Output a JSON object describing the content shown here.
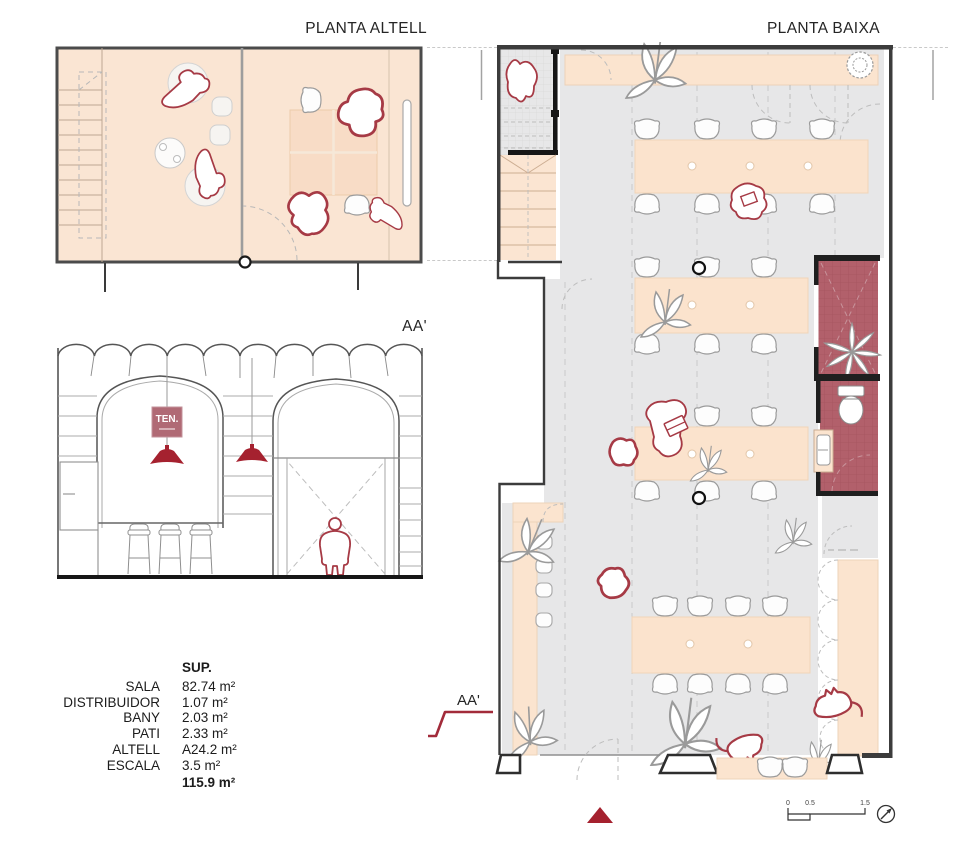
{
  "titles": {
    "altell": "PLANTA ALTELL",
    "baixa": "PLANTA BAIXA",
    "section": "AA'",
    "section_marker": "AA'"
  },
  "section": {
    "sign_text": "TEN."
  },
  "sup_table": {
    "header": "SUP.",
    "rows": [
      {
        "label": "SALA",
        "value": "82.74 m²"
      },
      {
        "label": "DISTRIBUIDOR",
        "value": "1.07 m²"
      },
      {
        "label": "BANY",
        "value": "2.03 m²"
      },
      {
        "label": "PATI",
        "value": "2.33 m²"
      },
      {
        "label": "ALTELL",
        "value": "A24.2 m²"
      },
      {
        "label": "ESCALA",
        "value": "3.5 m²"
      }
    ],
    "total": "115.9 m²"
  },
  "scale_bar": {
    "ticks": [
      "0",
      "0.5",
      "1.5"
    ]
  },
  "colors": {
    "accent_red": "#a5212f",
    "figure_red": "#a63a45",
    "tile_maroon": "#b2606b",
    "floor_peach": "#fae5d3",
    "floor_grey": "#e7e7e8",
    "furniture_peach": "#fbe3cd",
    "wall_dark": "#3c3c3c",
    "sign_maroon": "#b06a75"
  }
}
